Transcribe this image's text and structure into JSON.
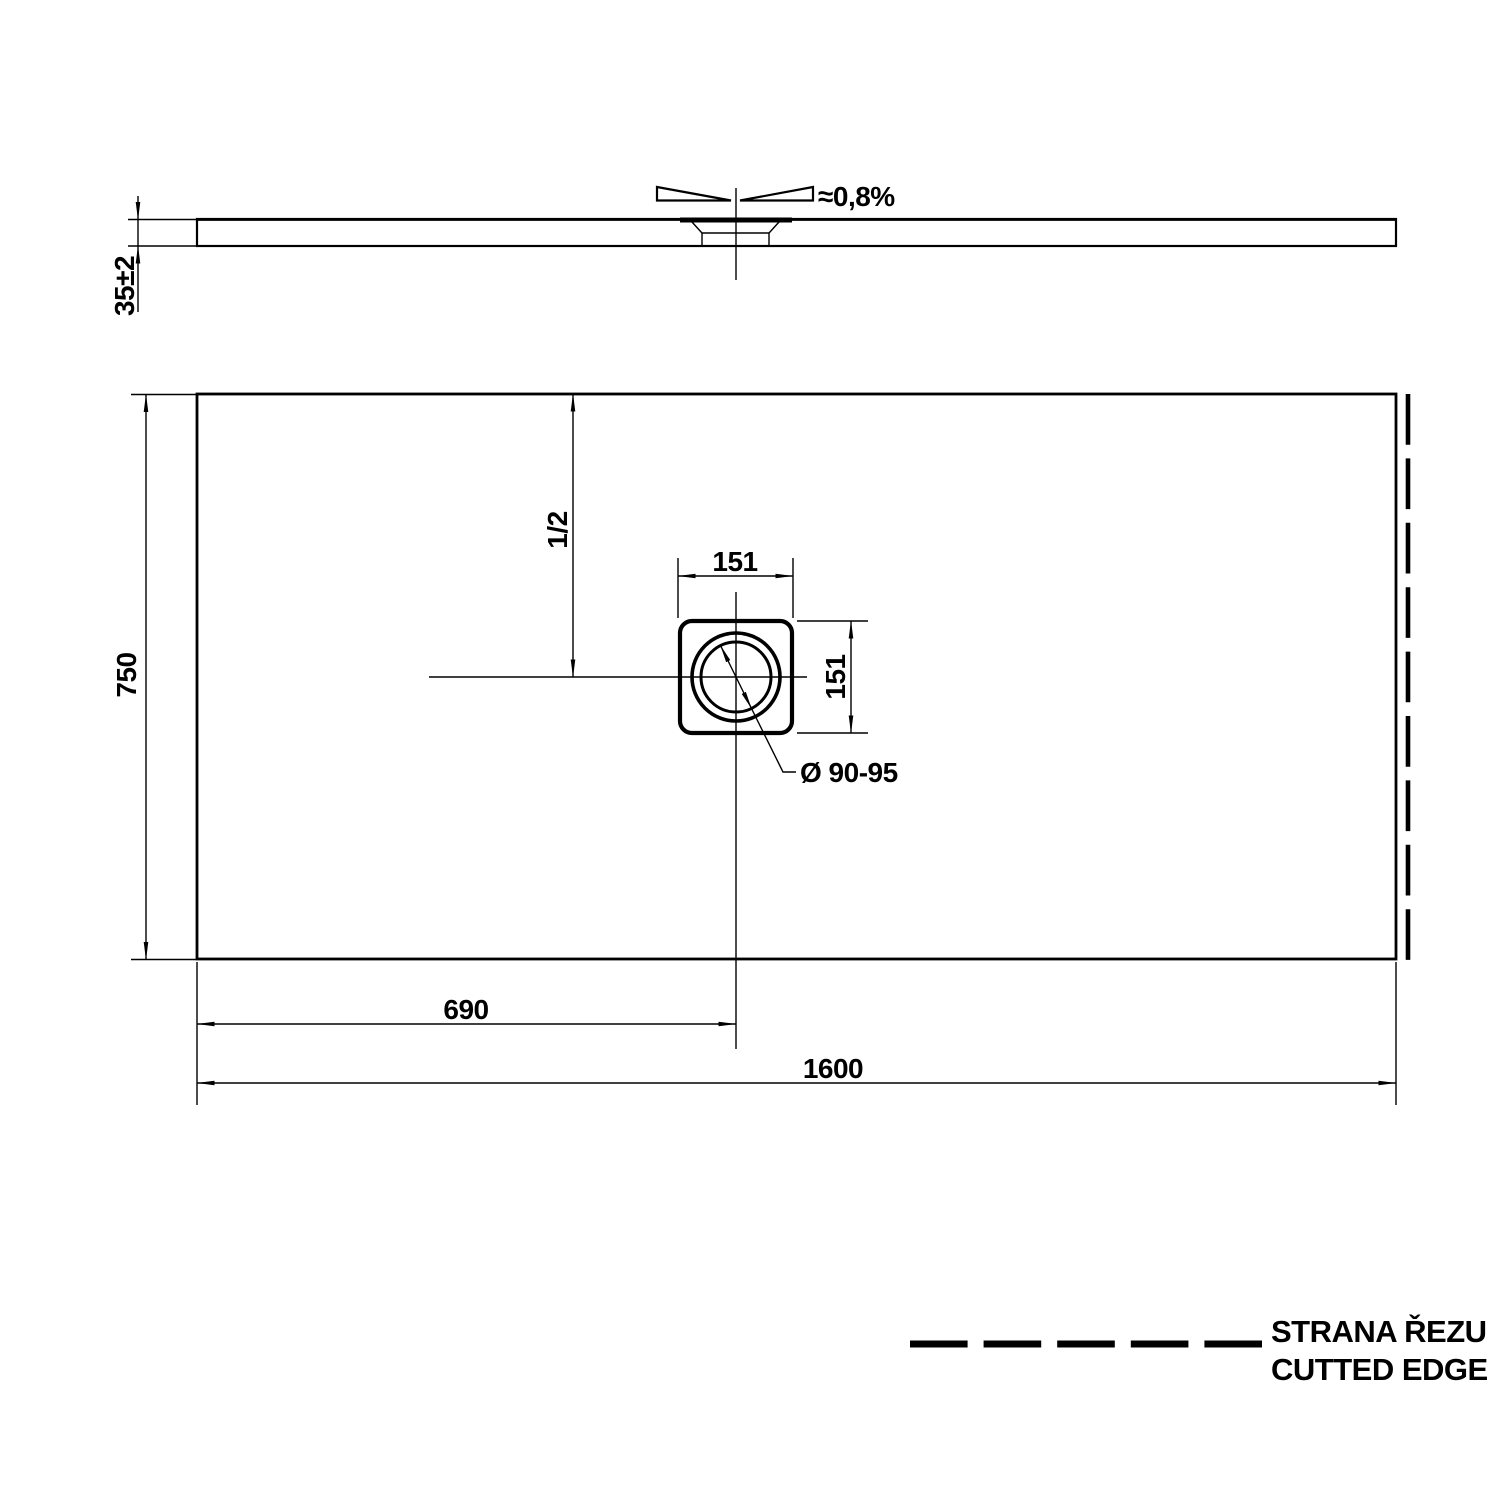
{
  "side_view": {
    "thickness_label": "35±2",
    "slope_label": "≈0,8%"
  },
  "plan_view": {
    "length_label": "1600",
    "width_label": "750",
    "drain_offset_label": "690",
    "half_label": "1/2",
    "drain_width_label": "151",
    "drain_height_label": "151",
    "drain_diameter_label": "Ø 90-95"
  },
  "legend": {
    "line1": "STRANA ŘEZU",
    "line2": "CUTTED EDGE"
  },
  "colors": {
    "ink": "#000000",
    "paper": "#ffffff"
  }
}
